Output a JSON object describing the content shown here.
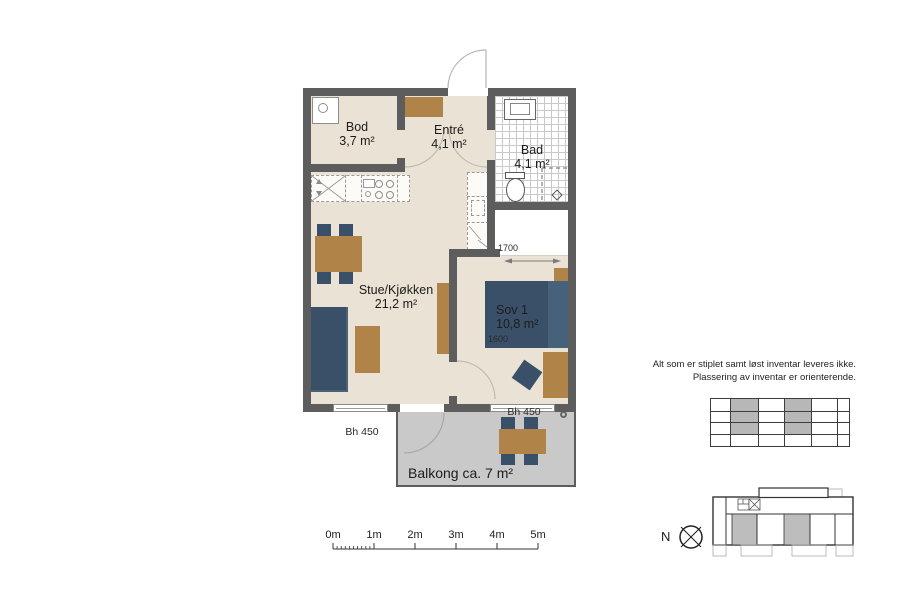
{
  "rooms": {
    "bod": {
      "name": "Bod",
      "area": "3,7 m²"
    },
    "entre": {
      "name": "Entré",
      "area": "4,1 m²"
    },
    "bad": {
      "name": "Bad",
      "area": "4,1 m²"
    },
    "stue": {
      "name": "Stue/Kjøkken",
      "area": "21,2 m²"
    },
    "sov1": {
      "name": "Sov 1",
      "area": "10,8 m²"
    },
    "balcony": {
      "name": "Balkong ca. 7 m²"
    }
  },
  "dimensions": {
    "wardrobe_width": "1700",
    "bed_width": "1600",
    "window_left": "Bh 450",
    "window_balcony": "Bh 450"
  },
  "scale": {
    "labels": [
      "0m",
      "1m",
      "2m",
      "3m",
      "4m",
      "5m"
    ]
  },
  "compass": {
    "label": "N"
  },
  "disclaimer": {
    "line1": "Alt som er stiplet samt løst inventar leveres ikke.",
    "line2": "Plassering av inventar er orienterende."
  },
  "colors": {
    "wall": "#5d5d5d",
    "floor": "#eae2d4",
    "furniture_wood": "#b08349",
    "furniture_upholstery": "#3a5068",
    "balcony": "#c9c9c9",
    "keyplan_unit": "#bdbdbd"
  }
}
